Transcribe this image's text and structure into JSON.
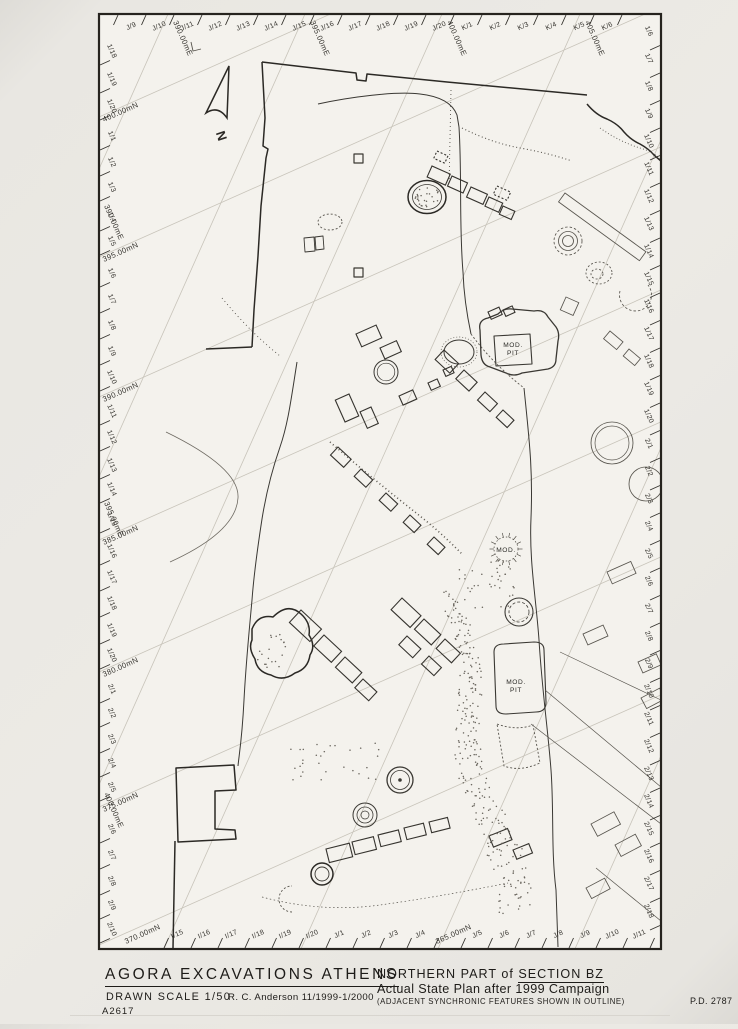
{
  "title_block": {
    "agency": "AGORA EXCAVATIONS ATHENS",
    "drawn_scale": "DRAWN SCALE 1/50",
    "author_credit": "R. C. Anderson 11/1999-1/2000",
    "drawing_number": "A2617",
    "plan_title_prefix": "NORTHERN PART of ",
    "plan_title_section": "SECTION BZ",
    "plan_subtitle": "Actual State Plan after 1999 Campaign",
    "plan_note": "(ADJACENT SYNCHRONIC FEATURES SHOWN IN OUTLINE)",
    "pd_number": "P.D. 2787"
  },
  "compass": {
    "north_label": "N"
  },
  "map_labels": {
    "mod_pit_a_line1": "MOD.",
    "mod_pit_a_line2": "PIT",
    "mod_b": "MOD.",
    "mod_pit_c_line1": "MOD.",
    "mod_pit_c_line2": "PIT"
  },
  "edges": {
    "top": {
      "labels": [
        "J/9",
        "J/10",
        "J/11",
        "J/12",
        "J/13",
        "J/14",
        "J/15",
        "J/16",
        "J/17",
        "J/18",
        "J/19",
        "J/20",
        "K/1",
        "K/2",
        "K/3",
        "K/4",
        "K/5",
        "K/6"
      ]
    },
    "right": {
      "labels": [
        "1/6",
        "1/7",
        "1/8",
        "1/9",
        "1/10",
        "1/11",
        "1/12",
        "1/13",
        "1/14",
        "1/15",
        "1/16",
        "1/17",
        "1/18",
        "1/19",
        "1/20",
        "2/1",
        "2/2",
        "2/3",
        "2/4",
        "2/5",
        "2/6",
        "2/7",
        "2/8",
        "2/9",
        "2/10",
        "2/11",
        "2/12",
        "2/13",
        "2/14",
        "2/15",
        "2/16",
        "2/17",
        "2/18"
      ]
    },
    "bottom": [
      {
        "t": "I/15",
        "x": 178
      },
      {
        "t": "I/16",
        "x": 205
      },
      {
        "t": "I/17",
        "x": 232
      },
      {
        "t": "I/18",
        "x": 259
      },
      {
        "t": "I/19",
        "x": 286
      },
      {
        "t": "I/20",
        "x": 313
      },
      {
        "t": "J/1",
        "x": 340
      },
      {
        "t": "J/2",
        "x": 367
      },
      {
        "t": "J/3",
        "x": 394
      },
      {
        "t": "J/4",
        "x": 421
      },
      {
        "t": "J/5",
        "x": 478
      },
      {
        "t": "J/6",
        "x": 505
      },
      {
        "t": "J/7",
        "x": 532
      },
      {
        "t": "J/8",
        "x": 559
      },
      {
        "t": "J/9",
        "x": 586
      },
      {
        "t": "J/10",
        "x": 613
      },
      {
        "t": "J/11",
        "x": 640
      }
    ],
    "left": [
      {
        "t": "1/18",
        "y": 52
      },
      {
        "t": "1/19",
        "y": 80
      },
      {
        "t": "1/20",
        "y": 107
      },
      {
        "t": "1/1",
        "y": 137
      },
      {
        "t": "1/2",
        "y": 163
      },
      {
        "t": "1/3",
        "y": 188
      },
      {
        "t": "1/4",
        "y": 218
      },
      {
        "t": "1/5",
        "y": 242
      },
      {
        "t": "1/6",
        "y": 274
      },
      {
        "t": "1/7",
        "y": 300
      },
      {
        "t": "1/8",
        "y": 326
      },
      {
        "t": "1/9",
        "y": 352
      },
      {
        "t": "1/10",
        "y": 378
      },
      {
        "t": "1/11",
        "y": 412
      },
      {
        "t": "1/12",
        "y": 438
      },
      {
        "t": "1/13",
        "y": 466
      },
      {
        "t": "1/14",
        "y": 490
      },
      {
        "t": "1/15",
        "y": 520
      },
      {
        "t": "1/16",
        "y": 552
      },
      {
        "t": "1/17",
        "y": 578
      },
      {
        "t": "1/18",
        "y": 604
      },
      {
        "t": "1/19",
        "y": 631
      },
      {
        "t": "1/20",
        "y": 656
      },
      {
        "t": "2/1",
        "y": 690
      },
      {
        "t": "2/2",
        "y": 714
      },
      {
        "t": "2/3",
        "y": 740
      },
      {
        "t": "2/4",
        "y": 764
      },
      {
        "t": "2/5",
        "y": 788
      },
      {
        "t": "2/6",
        "y": 830
      },
      {
        "t": "2/7",
        "y": 856
      },
      {
        "t": "2/8",
        "y": 882
      },
      {
        "t": "2/9",
        "y": 906
      },
      {
        "t": "2/10",
        "y": 930
      }
    ],
    "easting_top": [
      {
        "t": "390.00mE",
        "x": 168
      },
      {
        "t": "395.00mE",
        "x": 305
      },
      {
        "t": "400.00mE",
        "x": 442
      },
      {
        "t": "405.00mE",
        "x": 580
      }
    ],
    "easting_left": [
      {
        "t": "390.00mE",
        "y": 200
      },
      {
        "t": "395.00mE",
        "y": 497
      },
      {
        "t": "400.00mE",
        "y": 788
      }
    ],
    "northing_left": [
      {
        "t": "400.00mN",
        "y": 117
      },
      {
        "t": "395.00mN",
        "y": 257
      },
      {
        "t": "390.00mN",
        "y": 397
      },
      {
        "t": "385.00mN",
        "y": 540
      },
      {
        "t": "380.00mN",
        "y": 672
      },
      {
        "t": "375.00mN",
        "y": 807
      }
    ],
    "northing_bottom": [
      {
        "t": "370.00mN",
        "x": 126
      },
      {
        "t": "365.00mN",
        "x": 437
      }
    ]
  }
}
